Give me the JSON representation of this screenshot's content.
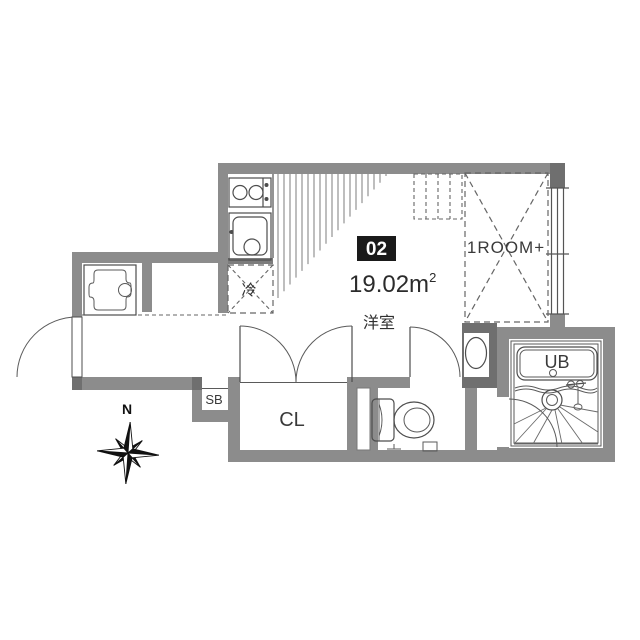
{
  "plan": {
    "unit_number": "02",
    "area_main": "19.02m",
    "area_sup": "2",
    "labels": {
      "main_room": "洋室",
      "loft": "1ROOM+",
      "refrigerator": "冷",
      "closet": "CL",
      "shoe_box": "SB",
      "unit_bath": "UB",
      "compass_north": "N"
    },
    "colors": {
      "wall": "#8c8c8c",
      "wall_dark": "#6f6f6f",
      "badge_background": "#1a1a1a",
      "badge_text": "#ffffff",
      "fixture_line": "#4d4d4d",
      "text": "#2f2f2f"
    }
  }
}
